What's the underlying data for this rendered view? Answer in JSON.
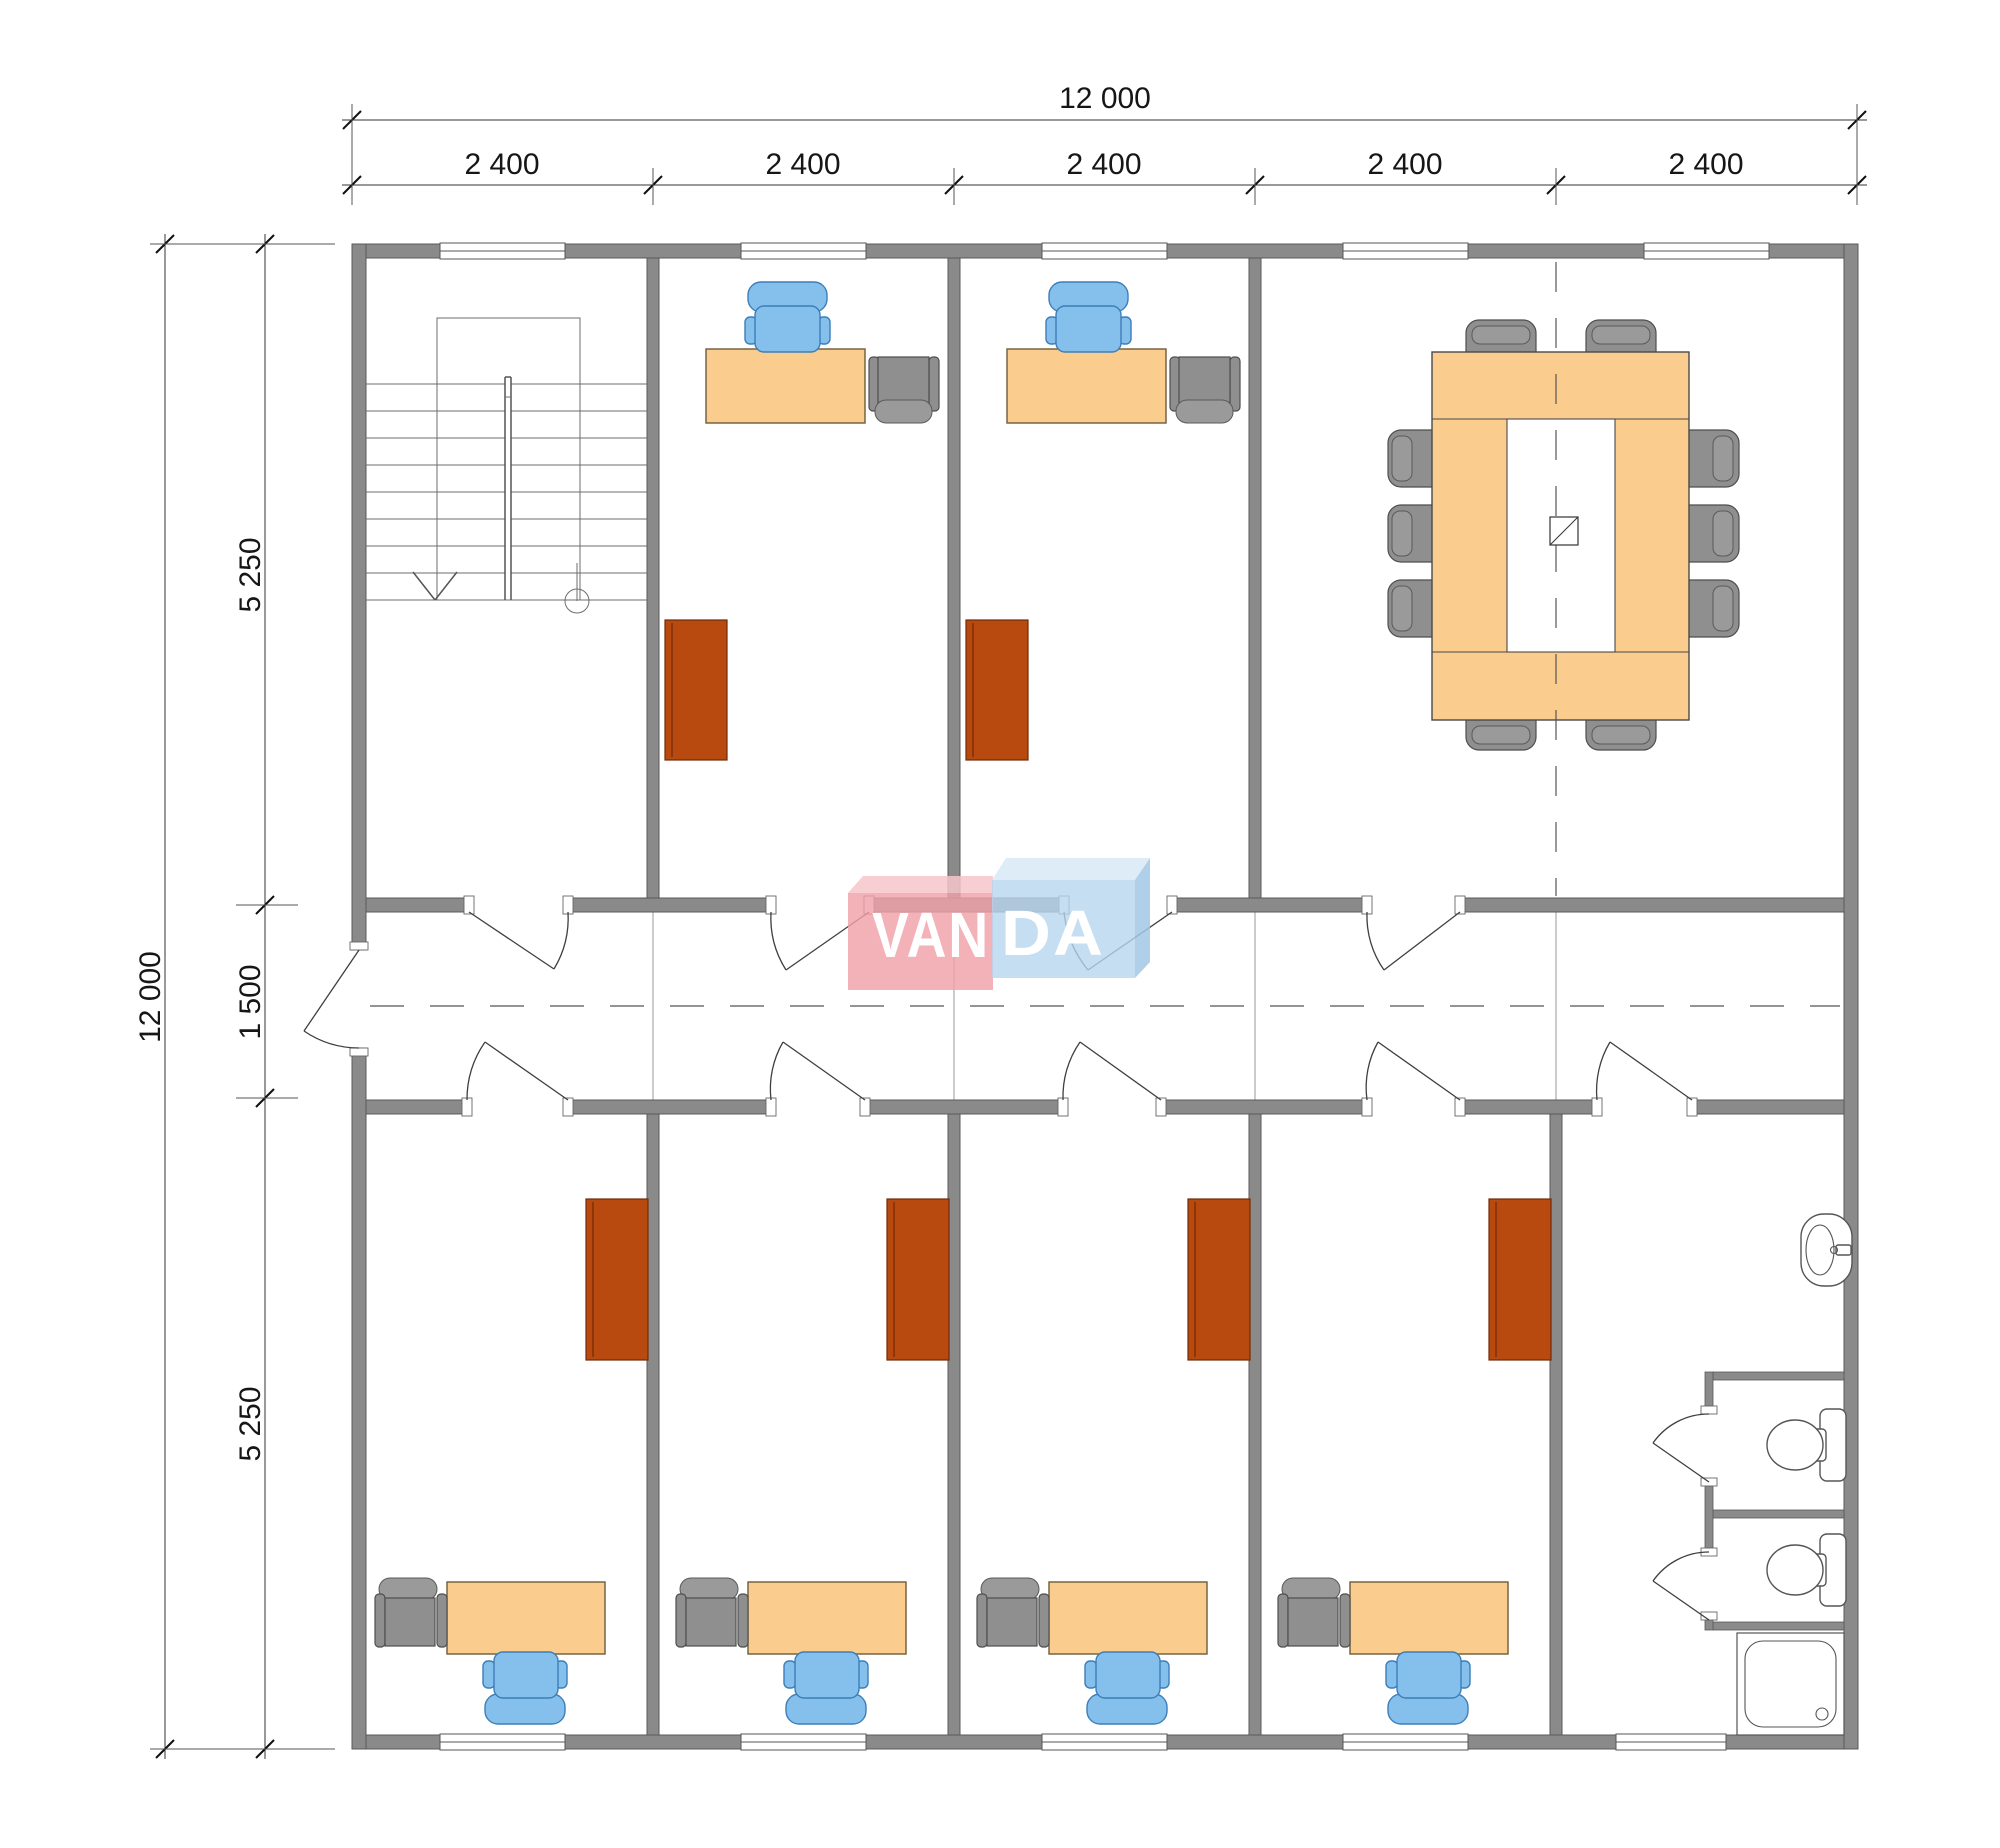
{
  "logo": {
    "name": "VANDA",
    "part1": "VAN",
    "part2": "DA"
  },
  "dimensions": {
    "top": {
      "total": "12 000",
      "segments": [
        "2 400",
        "2 400",
        "2 400",
        "2 400",
        "2 400"
      ]
    },
    "left": {
      "total": "12 000",
      "segments": [
        "5 250",
        "1 500",
        "5 250"
      ]
    }
  },
  "colors": {
    "wall_gray": "#8A8A8A",
    "desk_orange": "#FACC8E",
    "chair_blue": "#85BFEC",
    "chair_gray": "#8F8F8F",
    "cabinet_rust": "#B8490F",
    "logo_pink": "#F2ACB3",
    "logo_blue": "#BCD8EE",
    "dimension_text": "#161616"
  }
}
